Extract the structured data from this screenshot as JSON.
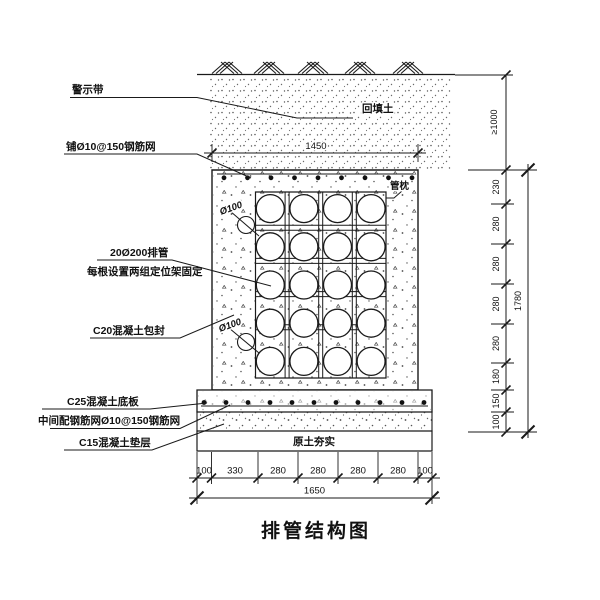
{
  "title": "排管结构图",
  "callouts": {
    "warning_tape": "警示带",
    "top_mesh": "铺Ø10@150钢筋网",
    "pipes_line1": "20Ø200排管",
    "pipes_line2": "每根设置两组定位架固定",
    "encasement": "C20混凝土包封",
    "base_slab": "C25混凝土底板",
    "middle_mesh": "中间配钢筋网Ø10@150钢筋网",
    "cushion": "C15混凝土垫层",
    "backfill": "回填土",
    "pipe_pillow": "管枕",
    "compacted_soil": "原土夯实",
    "pipe_dia_upper": "Ø100",
    "pipe_dia_lower": "Ø100"
  },
  "dimensions": {
    "top_width": "1450",
    "cover_depth": "≥1000",
    "right_chain": [
      "230",
      "280",
      "280",
      "280",
      "280",
      "180",
      "150",
      "100"
    ],
    "right_total": "1780",
    "bottom_chain": [
      "100",
      "330",
      "280",
      "280",
      "280",
      "280",
      "100"
    ],
    "bottom_total": "1650"
  },
  "drawing": {
    "pipe_rows": 5,
    "pipe_cols": 4,
    "pipe_count": 20
  },
  "colors": {
    "line": "#1a1a1a",
    "background": "#ffffff"
  }
}
